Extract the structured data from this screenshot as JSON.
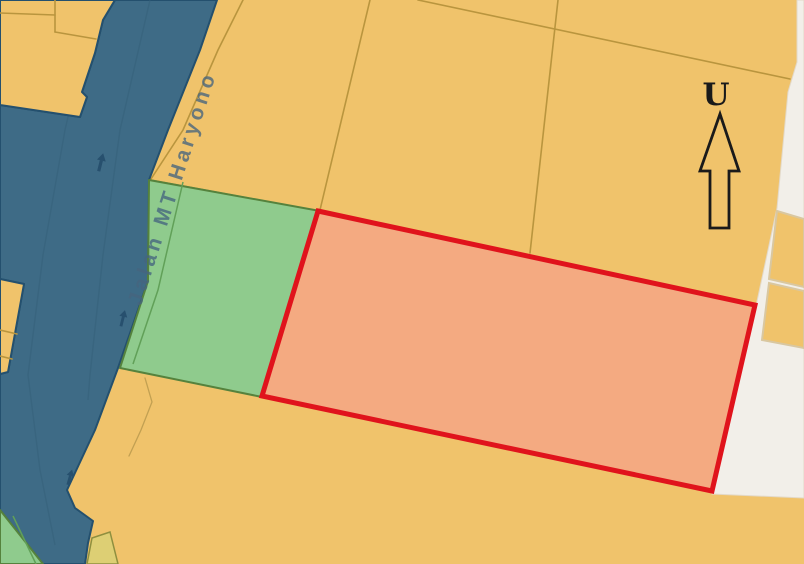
{
  "map": {
    "road": {
      "label": "Jalan MT Haryono"
    },
    "north_arrow": {
      "label": "U",
      "meaning": "North indicator"
    },
    "highlight_parcel": {
      "name": "selected parcel outline"
    },
    "colors": {
      "zone_orange": "#f0c36b",
      "zone_green": "#8fcb8d",
      "road_blue": "#3e6b86",
      "road_arrow": "#27506e",
      "highlight_fill": "#f4aa81",
      "highlight_stroke": "#e0131c",
      "white_area": "#f2efe9",
      "label_color": "#46657f",
      "arrow_black": "#1a1a1a"
    }
  }
}
